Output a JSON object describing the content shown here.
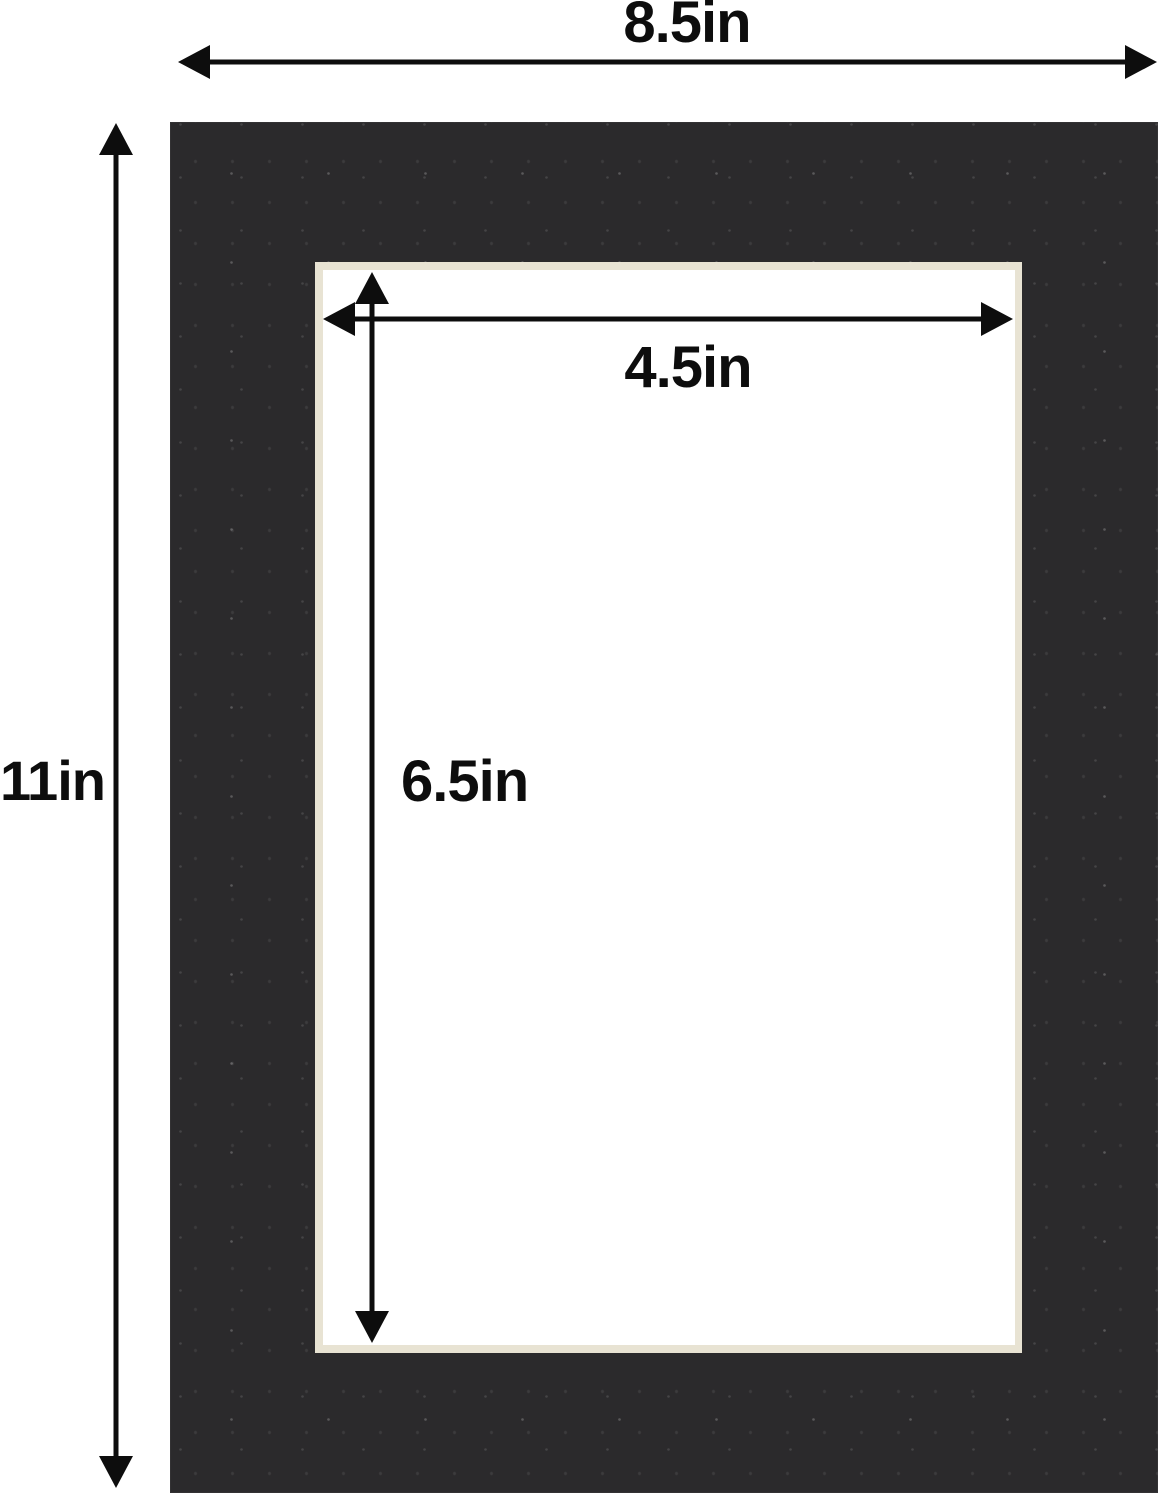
{
  "diagram": {
    "description": "picture-mat-dimension-diagram",
    "labels": {
      "outer_width": "8.5in",
      "outer_height": "11in",
      "opening_width": "4.5in",
      "opening_height": "6.5in"
    },
    "colors": {
      "mat_board": "#2b2a2c",
      "bevel_edge": "#e8e3d3",
      "opening": "#ffffff",
      "background": "#ffffff",
      "dimension_lines": "#0d0d0d"
    }
  }
}
